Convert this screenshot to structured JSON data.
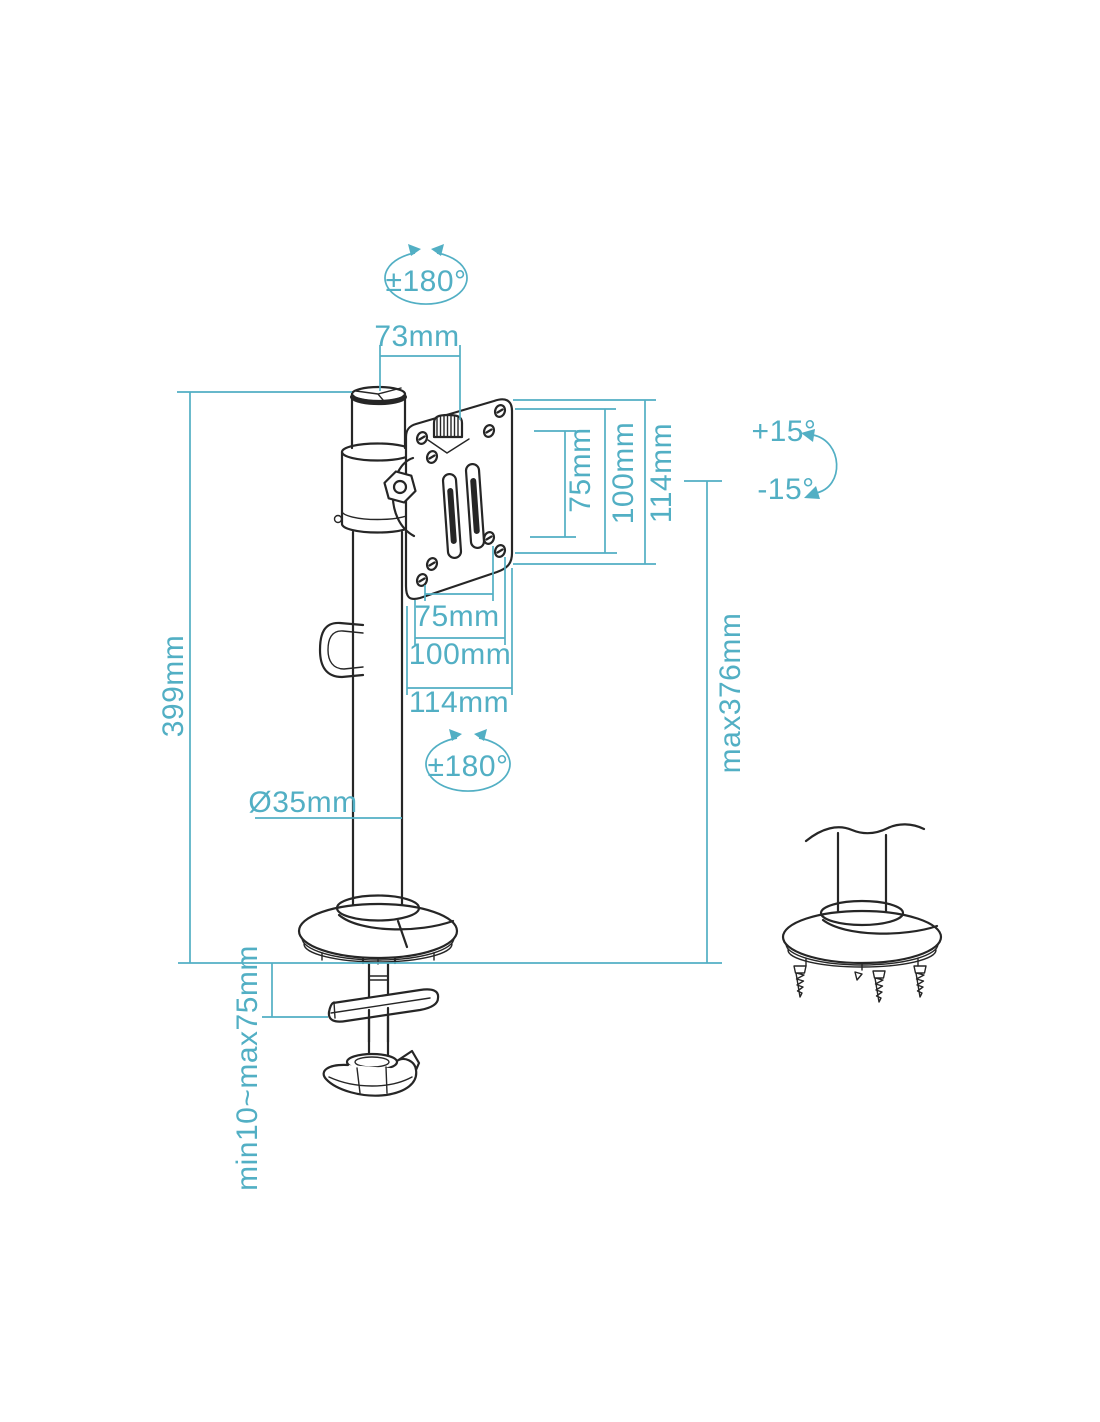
{
  "diagram": {
    "type": "technical dimension drawing",
    "subject": "single monitor desk mount pole with VESA plate, desk clamp and grommet base detail",
    "colors": {
      "background": "#ffffff",
      "line": "#262626",
      "dimension": "#52afc4"
    },
    "dimensions": {
      "top_rotation": "±180°",
      "top_width": "73mm",
      "vesa_vertical_75": "75mm",
      "vesa_vertical_100": "100mm",
      "vesa_vertical_114": "114mm",
      "tilt_up": "+15°",
      "tilt_down": "-15°",
      "vesa_horizontal_75": "75mm",
      "vesa_horizontal_100": "100mm",
      "vesa_horizontal_114": "114mm",
      "pole_height": "399mm",
      "max_monitor_height": "max376mm",
      "pole_rotation": "±180°",
      "pole_diameter": "Ø35mm",
      "desk_thickness": "min10~max75mm"
    }
  }
}
